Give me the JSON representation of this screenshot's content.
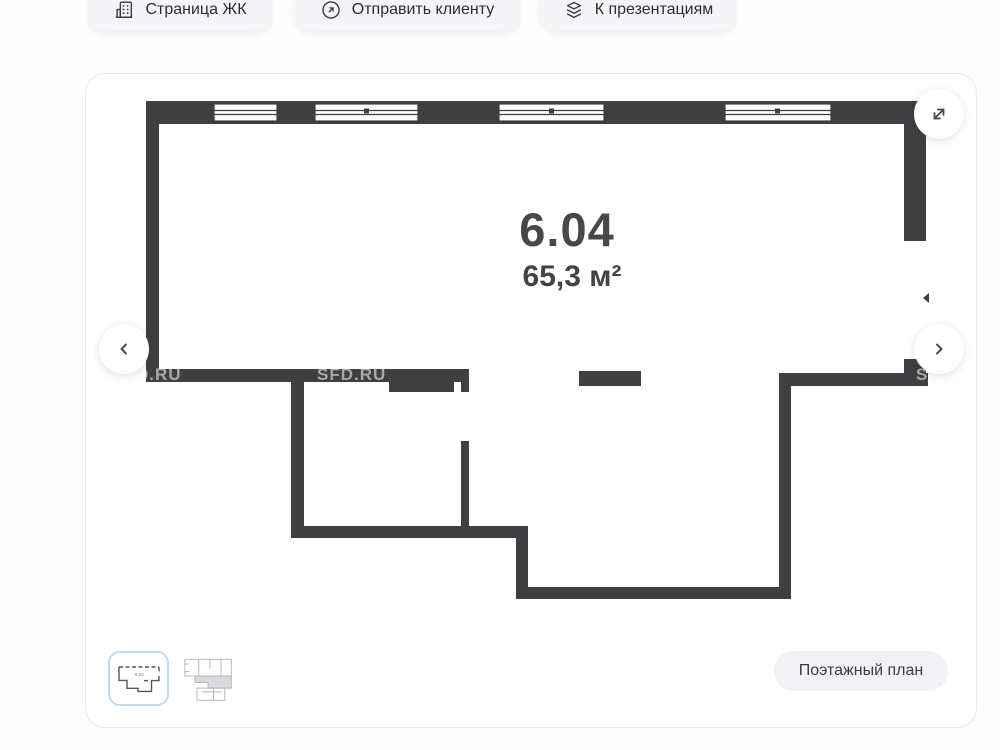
{
  "toolbar": {
    "buttons": [
      {
        "label": "Страница ЖК",
        "icon": "building-icon"
      },
      {
        "label": "Отправить клиенту",
        "icon": "send-arrow-icon"
      },
      {
        "label": "К презентациям",
        "icon": "layers-icon"
      }
    ]
  },
  "viewer": {
    "unit_number": "6.04",
    "unit_area": "65,3 м²",
    "watermark_left": "D.RU",
    "watermark_center": "SFD.RU",
    "watermark_right": "S",
    "controls": {
      "prev_icon": "chevron-left",
      "next_icon": "chevron-right",
      "fullscreen_icon": "expand-arrows"
    },
    "thumbnails": [
      {
        "name": "unit-plan-thumbnail",
        "selected": true,
        "mini_label": "6.04"
      },
      {
        "name": "floor-plate-thumbnail",
        "selected": false,
        "mini_label": ""
      }
    ],
    "floor_plan_button_label": "Поэтажный план"
  },
  "colors": {
    "wall": "#3f3f42",
    "thumbnail_selected_border": "#c3d9f1",
    "page_background": "#fdfdfe",
    "card_background": "#ffffff",
    "toolbar_button_background": "#f5f5f7"
  }
}
